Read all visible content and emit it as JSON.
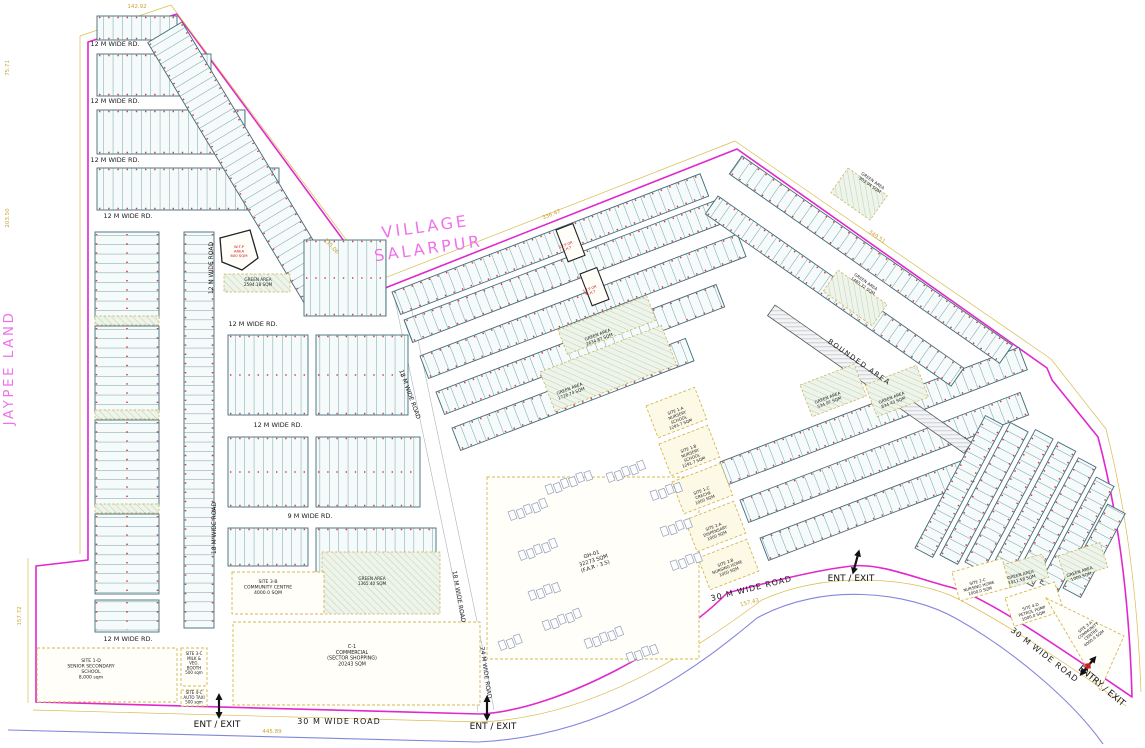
{
  "title_labels": {
    "village": [
      "VILLAGE",
      "SALARPUR"
    ],
    "jaypee": "JAYPEE LAND"
  },
  "colors": {
    "boundary_magenta": "#e028cc",
    "dimension_yellow": "#c9a431",
    "road_blue": "#8585dc",
    "plot_line_teal": "#4a7582",
    "red_tick": "#d34040",
    "village_text": "#ef72ea",
    "parcel_dash": "#d4b84e",
    "red_text": "#cc1111"
  },
  "paths": [
    {
      "n": "site-boundary",
      "d": "M88,42 L177,14 L380,290 L737,149 L1047,368 L1052,380 L1098,437 Q1128,550 1132,697 C1060,648 985,596 950,587 C915,578 880,563 852,566 C815,570 762,584 727,593 C682,640 562,710 480,714 L36,702 L36,566 L88,560 Z",
      "c": "#e028cc",
      "w": 1.6
    },
    {
      "n": "dimension-line",
      "d": "M80,36 L171,5 L377,281 L735,141 L1051,359 L1106,429 Q1136,548 1141,692 M80,36 L80,554 M28,558 L28,703 M33,710 L480,722 C600,717 702,644 762,600 C822,572 905,576 952,596 C1005,622 1082,674 1126,706",
      "c": "#d9bc4e",
      "w": 0.7
    },
    {
      "n": "outer-road-line",
      "d": "M8,730 L478,742 C612,736 704,662 757,618 C822,582 908,591 957,619 C1012,650 1072,700 1103,744",
      "c": "#8585dc",
      "w": 1.1
    },
    {
      "n": "road-edge-18m",
      "d": "M395,300 L468,648 L478,712 M409,297 L482,645 L494,710",
      "c": "#aab4bc",
      "w": 0.6
    }
  ],
  "blocks": [
    {
      "x": 97,
      "y": 16,
      "w": 80,
      "h": 24,
      "r": 0,
      "d": "v"
    },
    {
      "x": 97,
      "y": 54,
      "w": 114,
      "h": 42,
      "r": 0,
      "d": "v"
    },
    {
      "x": 97,
      "y": 110,
      "w": 148,
      "h": 44,
      "r": 0,
      "d": "v"
    },
    {
      "x": 97,
      "y": 168,
      "w": 182,
      "h": 42,
      "r": 0,
      "d": "v"
    },
    {
      "x": 182,
      "y": 22,
      "w": 310,
      "h": 40,
      "r": 59,
      "d": "v"
    },
    {
      "x": 95,
      "y": 232,
      "w": 64,
      "h": 86,
      "r": 0,
      "d": "h"
    },
    {
      "x": 95,
      "y": 326,
      "w": 64,
      "h": 86,
      "r": 0,
      "d": "h"
    },
    {
      "x": 95,
      "y": 420,
      "w": 64,
      "h": 86,
      "r": 0,
      "d": "h"
    },
    {
      "x": 95,
      "y": 514,
      "w": 64,
      "h": 80,
      "r": 0,
      "d": "h"
    },
    {
      "x": 95,
      "y": 600,
      "w": 64,
      "h": 32,
      "r": 0,
      "d": "h"
    },
    {
      "x": 184,
      "y": 232,
      "w": 30,
      "h": 396,
      "r": 0,
      "d": "h"
    },
    {
      "x": 304,
      "y": 240,
      "w": 82,
      "h": 76,
      "r": 0,
      "d": "v"
    },
    {
      "x": 228,
      "y": 335,
      "w": 80,
      "h": 80,
      "r": 0,
      "d": "v"
    },
    {
      "x": 316,
      "y": 335,
      "w": 92,
      "h": 80,
      "r": 0,
      "d": "v"
    },
    {
      "x": 228,
      "y": 437,
      "w": 80,
      "h": 70,
      "r": 0,
      "d": "v"
    },
    {
      "x": 316,
      "y": 437,
      "w": 104,
      "h": 70,
      "r": 0,
      "d": "v"
    },
    {
      "x": 228,
      "y": 528,
      "w": 80,
      "h": 38,
      "r": 0,
      "d": "v"
    },
    {
      "x": 316,
      "y": 528,
      "w": 120,
      "h": 46,
      "r": 0,
      "d": "v"
    },
    {
      "x": 392,
      "y": 292,
      "w": 330,
      "h": 24,
      "r": -21,
      "d": "v"
    },
    {
      "x": 404,
      "y": 320,
      "w": 340,
      "h": 24,
      "r": -21,
      "d": "v"
    },
    {
      "x": 420,
      "y": 356,
      "w": 340,
      "h": 24,
      "r": -21,
      "d": "v"
    },
    {
      "x": 436,
      "y": 392,
      "w": 300,
      "h": 24,
      "r": -21,
      "d": "v"
    },
    {
      "x": 452,
      "y": 428,
      "w": 250,
      "h": 24,
      "r": -21,
      "d": "v"
    },
    {
      "x": 720,
      "y": 462,
      "w": 320,
      "h": 24,
      "r": -21,
      "d": "v"
    },
    {
      "x": 740,
      "y": 500,
      "w": 300,
      "h": 24,
      "r": -21,
      "d": "v"
    },
    {
      "x": 760,
      "y": 538,
      "w": 220,
      "h": 24,
      "r": -21,
      "d": "v"
    },
    {
      "x": 742,
      "y": 156,
      "w": 330,
      "h": 22,
      "r": 35,
      "d": "v"
    },
    {
      "x": 718,
      "y": 196,
      "w": 300,
      "h": 22,
      "r": 35,
      "d": "v"
    },
    {
      "x": 915,
      "y": 548,
      "w": 150,
      "h": 20,
      "r": -62,
      "d": "v"
    },
    {
      "x": 940,
      "y": 555,
      "w": 150,
      "h": 20,
      "r": -62,
      "d": "v"
    },
    {
      "x": 965,
      "y": 562,
      "w": 150,
      "h": 20,
      "r": -62,
      "d": "v"
    },
    {
      "x": 990,
      "y": 570,
      "w": 145,
      "h": 20,
      "r": -62,
      "d": "v"
    },
    {
      "x": 1015,
      "y": 577,
      "w": 135,
      "h": 20,
      "r": -62,
      "d": "v"
    },
    {
      "x": 1040,
      "y": 583,
      "w": 120,
      "h": 20,
      "r": -62,
      "d": "v"
    },
    {
      "x": 1063,
      "y": 588,
      "w": 95,
      "h": 20,
      "r": -62,
      "d": "v"
    }
  ],
  "bounded_strip": {
    "x": 775,
    "y": 305,
    "w": 240,
    "h": 13,
    "r": 35
  },
  "greens": [
    {
      "x": 95,
      "y": 316,
      "w": 64,
      "h": 9,
      "r": 0
    },
    {
      "x": 95,
      "y": 410,
      "w": 64,
      "h": 9,
      "r": 0
    },
    {
      "x": 95,
      "y": 504,
      "w": 64,
      "h": 9,
      "r": 0
    },
    {
      "x": 322,
      "y": 552,
      "w": 118,
      "h": 62,
      "r": 0
    },
    {
      "x": 540,
      "y": 372,
      "w": 130,
      "h": 42,
      "r": -21
    },
    {
      "x": 558,
      "y": 330,
      "w": 95,
      "h": 26,
      "r": -21
    },
    {
      "x": 800,
      "y": 385,
      "w": 58,
      "h": 34,
      "r": -21
    },
    {
      "x": 865,
      "y": 385,
      "w": 55,
      "h": 34,
      "r": -21
    },
    {
      "x": 838,
      "y": 270,
      "w": 60,
      "h": 26,
      "r": 35
    },
    {
      "x": 848,
      "y": 168,
      "w": 48,
      "h": 30,
      "r": 35
    },
    {
      "x": 224,
      "y": 274,
      "w": 66,
      "h": 18,
      "r": 0
    },
    {
      "x": 998,
      "y": 566,
      "w": 46,
      "h": 24,
      "r": -15
    },
    {
      "x": 1058,
      "y": 556,
      "w": 44,
      "h": 26,
      "r": -18
    }
  ],
  "parcels": [
    {
      "n": "school-parcel",
      "x": 37,
      "y": 648,
      "w": 140,
      "h": 54
    },
    {
      "n": "community-centre-3b-parcel",
      "x": 232,
      "y": 572,
      "w": 92,
      "h": 42
    },
    {
      "n": "commercial-c1-parcel",
      "x": 233,
      "y": 622,
      "w": 247,
      "h": 83
    },
    {
      "n": "gh01-parcel",
      "x": 487,
      "y": 477,
      "w": 212,
      "h": 182
    },
    {
      "n": "milk-booth-parcel",
      "x": 181,
      "y": 648,
      "w": 26,
      "h": 38
    },
    {
      "n": "auto-taxi-parcel",
      "x": 181,
      "y": 690,
      "w": 26,
      "h": 16
    },
    {
      "n": "nursery-1a-parcel",
      "x": 646,
      "y": 406,
      "w": 52,
      "h": 34,
      "r": -21,
      "f": "#fdf9e7"
    },
    {
      "n": "nursery-1b-parcel",
      "x": 659,
      "y": 444,
      "w": 52,
      "h": 34,
      "r": -21,
      "f": "#fdf9e7"
    },
    {
      "n": "creche-1c-parcel",
      "x": 672,
      "y": 482,
      "w": 52,
      "h": 34,
      "r": -21,
      "f": "#fdf9e7"
    },
    {
      "n": "dispensary-2a-parcel",
      "x": 685,
      "y": 520,
      "w": 52,
      "h": 34,
      "r": -21,
      "f": "#fdf9e7"
    },
    {
      "n": "nursing-2b-parcel",
      "x": 698,
      "y": 558,
      "w": 52,
      "h": 34,
      "r": -21,
      "f": "#fdf9e7"
    },
    {
      "n": "nursing-2c-parcel",
      "x": 952,
      "y": 572,
      "w": 52,
      "h": 30,
      "r": -15
    },
    {
      "n": "petrol-pump-parcel",
      "x": 1005,
      "y": 598,
      "w": 52,
      "h": 30,
      "r": -18
    },
    {
      "n": "community-centre-3a-parcel",
      "pts": "1046,598 1124,636 1100,690"
    },
    {
      "n": "wtp-plot",
      "pts": "220,238 250,230 258,258 242,270 222,262",
      "sc": "#222222",
      "sw": 1.3,
      "dash": "none"
    },
    {
      "n": "stp-plot",
      "x": 556,
      "y": 230,
      "w": 18,
      "h": 34,
      "r": -21,
      "sc": "#222222",
      "sw": 1.1,
      "dash": "none"
    },
    {
      "n": "stp-plot",
      "x": 580,
      "y": 274,
      "w": 18,
      "h": 34,
      "r": -21,
      "sc": "#222222",
      "sw": 1.1,
      "dash": "none"
    }
  ],
  "clusters": [
    {
      "x": 508,
      "y": 512,
      "n": 5
    },
    {
      "x": 518,
      "y": 552,
      "n": 5
    },
    {
      "x": 528,
      "y": 592,
      "n": 4
    },
    {
      "x": 545,
      "y": 486,
      "n": 6
    },
    {
      "x": 606,
      "y": 474,
      "n": 5
    },
    {
      "x": 650,
      "y": 492,
      "n": 4
    },
    {
      "x": 660,
      "y": 528,
      "n": 4
    },
    {
      "x": 670,
      "y": 562,
      "n": 4
    },
    {
      "x": 542,
      "y": 622,
      "n": 5
    },
    {
      "x": 584,
      "y": 640,
      "n": 5
    },
    {
      "x": 626,
      "y": 654,
      "n": 4
    },
    {
      "x": 498,
      "y": 642,
      "n": 3
    }
  ],
  "labels": [
    {
      "n": "village-label",
      "t": [
        "VILLAGE",
        "SALARPUR"
      ],
      "x": 426,
      "y": 232,
      "r": -8,
      "s": 16,
      "c": "#ef72ea",
      "ls": 3,
      "lh": 22
    },
    {
      "n": "jaypee-label",
      "t": "JAYPEE LAND",
      "x": 13,
      "y": 368,
      "r": -90,
      "s": 13.5,
      "c": "#ef72ea",
      "ls": 2.5
    },
    {
      "n": "road-label",
      "t": "12 M WIDE RD.",
      "x": 115,
      "y": 46,
      "s": 6.5
    },
    {
      "n": "road-label",
      "t": "12 M WIDE RD.",
      "x": 115,
      "y": 103,
      "s": 6.5
    },
    {
      "n": "road-label",
      "t": "12 M WIDE RD.",
      "x": 115,
      "y": 162,
      "s": 6.5
    },
    {
      "n": "road-label",
      "t": "12 M WIDE RD.",
      "x": 128,
      "y": 218,
      "s": 6.5
    },
    {
      "n": "road-label",
      "t": "12 M WIDE RD.",
      "x": 253,
      "y": 326,
      "s": 6.5
    },
    {
      "n": "road-label",
      "t": "12 M WIDE RD.",
      "x": 278,
      "y": 427,
      "s": 6.5
    },
    {
      "n": "road-label",
      "t": "9 M WIDE RD.",
      "x": 310,
      "y": 518,
      "s": 6.5
    },
    {
      "n": "road-label",
      "t": "12 M WIDE RD.",
      "x": 128,
      "y": 641,
      "s": 6.5
    },
    {
      "n": "road-label",
      "t": "12 M WIDE ROAD",
      "x": 213,
      "y": 268,
      "r": -90,
      "s": 6
    },
    {
      "n": "road-label",
      "t": "18 M WIDE ROAD",
      "x": 216,
      "y": 528,
      "r": -90,
      "s": 6
    },
    {
      "n": "road-label",
      "t": "18 M WIDE ROAD",
      "x": 408,
      "y": 395,
      "r": 70,
      "s": 6
    },
    {
      "n": "road-label",
      "t": "18 M WIDE ROAD",
      "x": 457,
      "y": 597,
      "r": 80,
      "s": 6
    },
    {
      "n": "road-label",
      "t": "24 M WIDE ROAD",
      "x": 484,
      "y": 673,
      "r": 82,
      "s": 6
    },
    {
      "n": "road-label",
      "t": "30 M WIDE ROAD",
      "x": 339,
      "y": 724,
      "s": 8,
      "ls": 1
    },
    {
      "n": "road-label",
      "t": "30 M WIDE ROAD",
      "x": 752,
      "y": 591,
      "r": -14,
      "s": 8,
      "ls": 1
    },
    {
      "n": "road-label",
      "t": "30 M WIDE ROAD",
      "x": 1043,
      "y": 657,
      "r": 38,
      "s": 8,
      "ls": 1
    },
    {
      "n": "bounded-area-label",
      "t": "BOUNDED AREA",
      "x": 858,
      "y": 364,
      "r": 35,
      "s": 7,
      "ls": 1.5
    },
    {
      "n": "parcel-label",
      "t": [
        "SITE 1-D",
        "SENIOR SECONDARY",
        "SCHOOL",
        "8,000 sqm"
      ],
      "x": 91,
      "y": 662,
      "s": 4.6
    },
    {
      "n": "parcel-label",
      "t": [
        "SITE 3-B",
        "COMMUNITY CENTRE",
        "4000.0 SQM"
      ],
      "x": 268,
      "y": 583,
      "s": 4.6
    },
    {
      "n": "parcel-label",
      "t": [
        "C-1",
        "COMMERCIAL",
        "(SECTOR SHOPPING)",
        "20243 SQM"
      ],
      "x": 352,
      "y": 648,
      "s": 4.8
    },
    {
      "n": "parcel-label",
      "t": [
        "SITE 3-C",
        "MILK &",
        "VEG.",
        "BOOTH",
        "500 sqm"
      ],
      "x": 194,
      "y": 655,
      "s": 4
    },
    {
      "n": "parcel-label",
      "t": [
        "SITE 4-C",
        "AUTO TAXI",
        "500 sqm"
      ],
      "x": 194,
      "y": 694,
      "s": 4
    },
    {
      "n": "parcel-label",
      "t": [
        "GH-01",
        "32273 SQM",
        "(F.A.R - 3.5)"
      ],
      "x": 592,
      "y": 556,
      "r": -18,
      "s": 5.2
    },
    {
      "n": "parcel-label",
      "t": [
        "SITE 1-A",
        "NURSERY",
        "SCHOOL",
        "1293.7 SQM"
      ],
      "x": 676,
      "y": 412,
      "r": -21,
      "s": 4
    },
    {
      "n": "parcel-label",
      "t": [
        "SITE 1-B",
        "NURSERY",
        "SCHOOL",
        "1291.7 SQM"
      ],
      "x": 689,
      "y": 450,
      "r": -21,
      "s": 4
    },
    {
      "n": "parcel-label",
      "t": [
        "SITE 1-C",
        "CRECHE",
        "1000 SQM"
      ],
      "x": 702,
      "y": 492,
      "r": -21,
      "s": 4
    },
    {
      "n": "parcel-label",
      "t": [
        "SITE 2-A",
        "DISPENSARY",
        "1000 SQM"
      ],
      "x": 714,
      "y": 528,
      "r": -21,
      "s": 4
    },
    {
      "n": "parcel-label",
      "t": [
        "SITE 2-B",
        "NURSING HOME",
        "1000 SQM"
      ],
      "x": 726,
      "y": 564,
      "r": -21,
      "s": 4
    },
    {
      "n": "parcel-label",
      "t": [
        "SITE 2-C",
        "NURSING HOME",
        "1000.0 SQM"
      ],
      "x": 978,
      "y": 583,
      "r": -15,
      "s": 4
    },
    {
      "n": "parcel-label",
      "t": [
        "SITE 4-D",
        "PETROL PUMP",
        "1000.0 SQM"
      ],
      "x": 1031,
      "y": 608,
      "r": -18,
      "s": 4
    },
    {
      "n": "parcel-label",
      "t": [
        "SITE 3-A",
        "COMMUNITY",
        "CENTRE",
        "4000.0 SQM"
      ],
      "x": 1086,
      "y": 628,
      "r": -38,
      "s": 4
    },
    {
      "n": "green-area-label",
      "t": [
        "GREEN AREA",
        "1365.40 SQM"
      ],
      "x": 372,
      "y": 580,
      "s": 4.2
    },
    {
      "n": "green-area-label",
      "t": [
        "GREEN AREA",
        "1726.74 SQM"
      ],
      "x": 570,
      "y": 390,
      "r": -21,
      "s": 4.2
    },
    {
      "n": "green-area-label",
      "t": [
        "GREEN AREA",
        "2634.87 SQM"
      ],
      "x": 598,
      "y": 336,
      "r": -21,
      "s": 4.2
    },
    {
      "n": "green-area-label",
      "t": [
        "GREEN AREA",
        "534.97 SQM"
      ],
      "x": 828,
      "y": 399,
      "r": -21,
      "s": 4.2
    },
    {
      "n": "green-area-label",
      "t": [
        "GREEN AREA",
        "834.43 SQM"
      ],
      "x": 892,
      "y": 399,
      "r": -21,
      "s": 4.2
    },
    {
      "n": "green-area-label",
      "t": [
        "GREEN AREA",
        "1485.32 SQM"
      ],
      "x": 865,
      "y": 283,
      "r": 35,
      "s": 4.2
    },
    {
      "n": "green-area-label",
      "t": [
        "GREEN AREA",
        "903.94 SQM"
      ],
      "x": 872,
      "y": 182,
      "r": 35,
      "s": 4.2
    },
    {
      "n": "green-area-label",
      "t": [
        "GREEN AREA",
        "2594.18 SQM"
      ],
      "x": 258,
      "y": 281,
      "s": 4.2
    },
    {
      "n": "green-area-label",
      "t": [
        "GREEN AREA",
        "1911.58 SQM"
      ],
      "x": 1021,
      "y": 576,
      "r": -15,
      "s": 4.2
    },
    {
      "n": "green-area-label",
      "t": [
        "GREEN AREA",
        "1000 SQM"
      ],
      "x": 1080,
      "y": 573,
      "r": -18,
      "s": 4.2
    },
    {
      "n": "wtp-label",
      "t": [
        "W.T.P",
        "AREA",
        "600 SQM"
      ],
      "x": 239,
      "y": 248,
      "s": 3.8,
      "c": "#cc1111"
    },
    {
      "n": "stp-label",
      "t": [
        "S.T.P OR",
        "E.H.T"
      ],
      "x": 566,
      "y": 246,
      "r": -21,
      "s": 3.5,
      "c": "#cc1111"
    },
    {
      "n": "stp-label",
      "t": [
        "S.T.P OR",
        "E.H.T"
      ],
      "x": 590,
      "y": 290,
      "r": -21,
      "s": 3.5,
      "c": "#cc1111"
    }
  ],
  "dimensions": [
    {
      "t": "142.92",
      "x": 137,
      "y": 8
    },
    {
      "t": "75.71",
      "x": 9,
      "y": 68,
      "r": -90
    },
    {
      "t": "203.50",
      "x": 9,
      "y": 218,
      "r": -90
    },
    {
      "t": "157.72",
      "x": 21,
      "y": 616,
      "r": -90
    },
    {
      "t": "135.06",
      "x": 330,
      "y": 247,
      "r": 48
    },
    {
      "t": "336.47",
      "x": 552,
      "y": 216,
      "r": -21
    },
    {
      "t": "349.51",
      "x": 876,
      "y": 238,
      "r": 35
    },
    {
      "t": "445.89",
      "x": 272,
      "y": 733
    },
    {
      "t": "157.43",
      "x": 750,
      "y": 604,
      "r": -14
    }
  ],
  "ent_exit": [
    {
      "t": "ENT / EXIT",
      "x": 219,
      "y": 706,
      "r": 0,
      "lx": 217,
      "ly": 727,
      "lr": 0
    },
    {
      "t": "ENT / EXIT",
      "x": 487,
      "y": 708,
      "r": 0,
      "lx": 493,
      "ly": 729,
      "lr": 0
    },
    {
      "t": "ENT / EXIT",
      "x": 856,
      "y": 562,
      "r": 15,
      "lx": 851,
      "ly": 581,
      "lr": 0
    },
    {
      "t": "ENTRY / EXIT",
      "x": 1088,
      "y": 666,
      "r": 40,
      "lx": 1100,
      "ly": 688,
      "lr": 40,
      "red": 1
    }
  ]
}
